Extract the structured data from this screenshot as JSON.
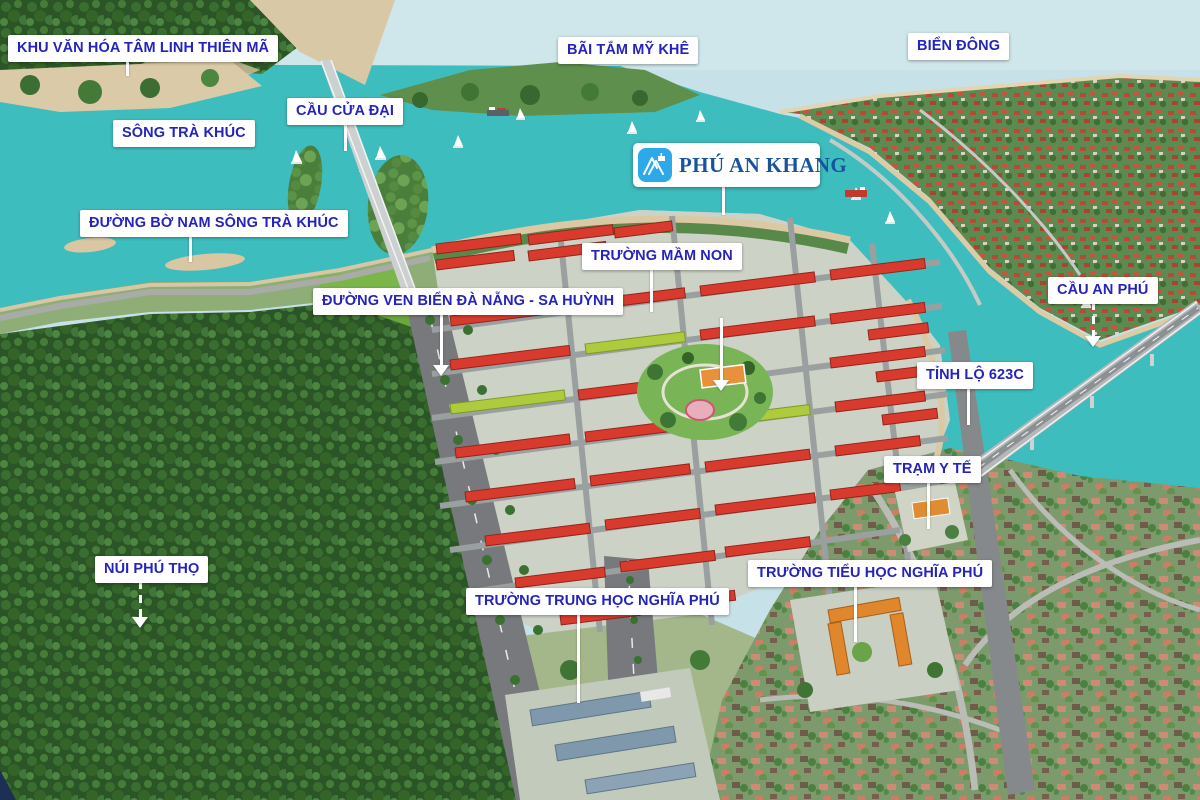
{
  "project_logo": {
    "name": "PHÚ AN KHANG",
    "icon": "mountain-monogram-icon"
  },
  "labels": [
    {
      "id": "khu-van-hoa",
      "text": "KHU VĂN HÓA TÂM LINH THIÊN MÃ"
    },
    {
      "id": "song-tra-khuc",
      "text": "SÔNG TRÀ KHÚC"
    },
    {
      "id": "cau-cua-dai",
      "text": "CẦU CỬA ĐẠI"
    },
    {
      "id": "bai-tam-my-khe",
      "text": "BÃI TẮM MỸ KHÊ"
    },
    {
      "id": "bien-dong",
      "text": "BIỂN ĐÔNG"
    },
    {
      "id": "duong-bo-nam",
      "text": "ĐƯỜNG BỜ NAM SÔNG TRÀ KHÚC"
    },
    {
      "id": "truong-mam-non",
      "text": "TRƯỜNG MẦM NON"
    },
    {
      "id": "cau-an-phu",
      "text": "CẦU AN PHÚ"
    },
    {
      "id": "duong-ven-bien",
      "text": "ĐƯỜNG VEN BIỂN ĐÀ NẴNG - SA HUỲNH"
    },
    {
      "id": "tinh-lo-623c",
      "text": "TỈNH LỘ 623C"
    },
    {
      "id": "tram-y-te",
      "text": "TRẠM Y TẾ"
    },
    {
      "id": "nui-phu-tho",
      "text": "NÚI PHÚ THỌ"
    },
    {
      "id": "truong-trung-hoc",
      "text": "TRƯỜNG TRUNG HỌC NGHĨA PHÚ"
    },
    {
      "id": "truong-tieu-hoc",
      "text": "TRƯỜNG TIỂU HỌC NGHĨA PHÚ"
    }
  ],
  "colors": {
    "label_text": "#2424bc",
    "label_bg": "#ffffff",
    "leader_line": "#ffffff",
    "water_teal": "#3ebdbf",
    "sea_pale": "#c6e1e7",
    "sand": "#dbc9a6",
    "roof_red": "#d83b2e",
    "roof_lime": "#aeca3d",
    "village_roof": "#cd8a74",
    "forest_green": "#2c5527",
    "road_gray": "#77797c",
    "logo_icon_bg": "#2ba9e9",
    "logo_text": "#17549d"
  }
}
